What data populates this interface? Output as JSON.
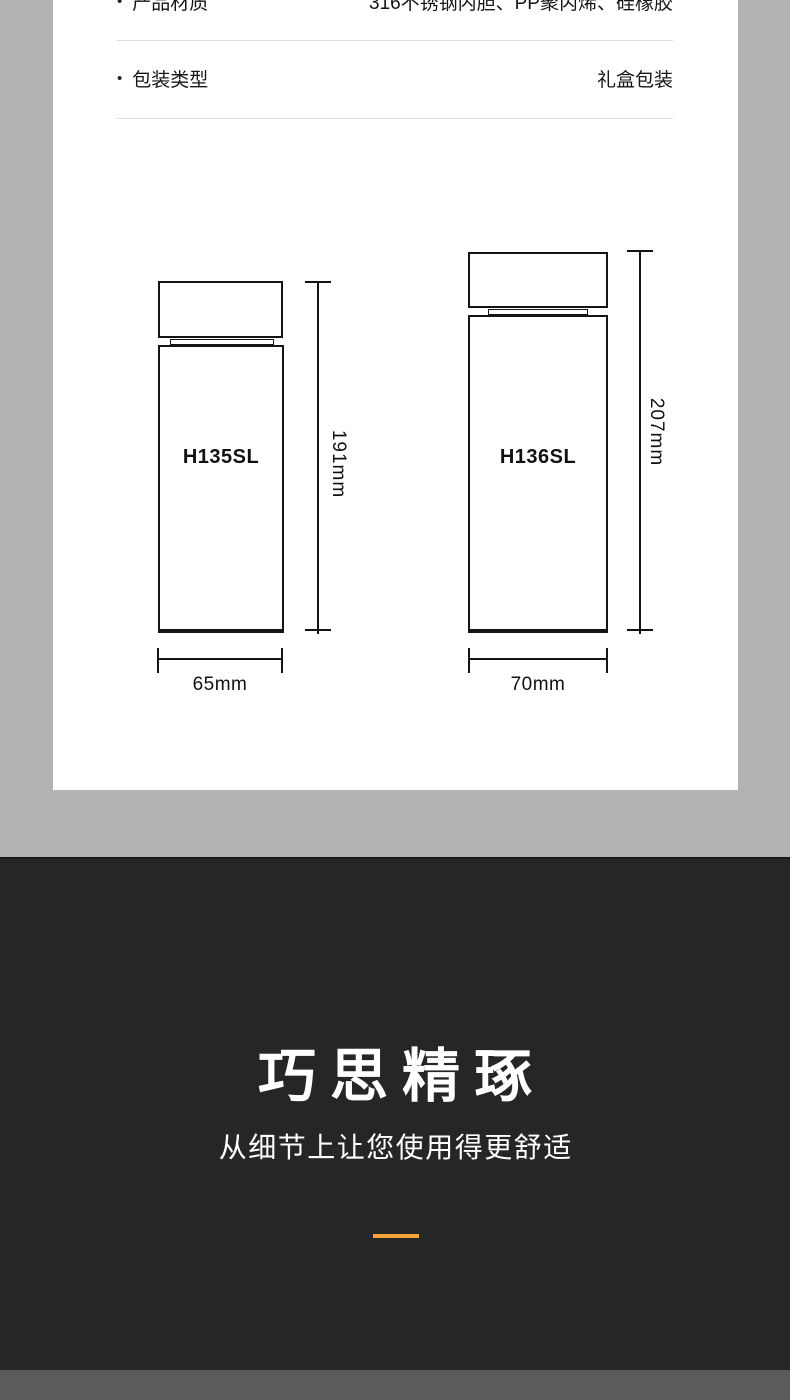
{
  "specs": {
    "bullet": "•",
    "rows": [
      {
        "label": "产品材质",
        "value": "316不锈钢内胆、PP聚丙烯、硅橡胶"
      },
      {
        "label": "包装类型",
        "value": "礼盒包装"
      }
    ]
  },
  "diagram": {
    "bottles": [
      {
        "model": "H135SL",
        "height_label": "191mm",
        "width_label": "65mm"
      },
      {
        "model": "H136SL",
        "height_label": "207mm",
        "width_label": "70mm"
      }
    ]
  },
  "feature_section": {
    "title": "巧思精琢",
    "subtitle": "从细节上让您使用得更舒适"
  },
  "colors": {
    "page_bg": "#b4b3b4",
    "card_bg": "#ffffff",
    "divider": "#dddddd",
    "line_ink": "#141414",
    "dark_section_bg": "#262626",
    "accent_orange": "#f3a339",
    "bottom_band": "#5c5b5c",
    "text_on_dark": "#ffffff"
  }
}
